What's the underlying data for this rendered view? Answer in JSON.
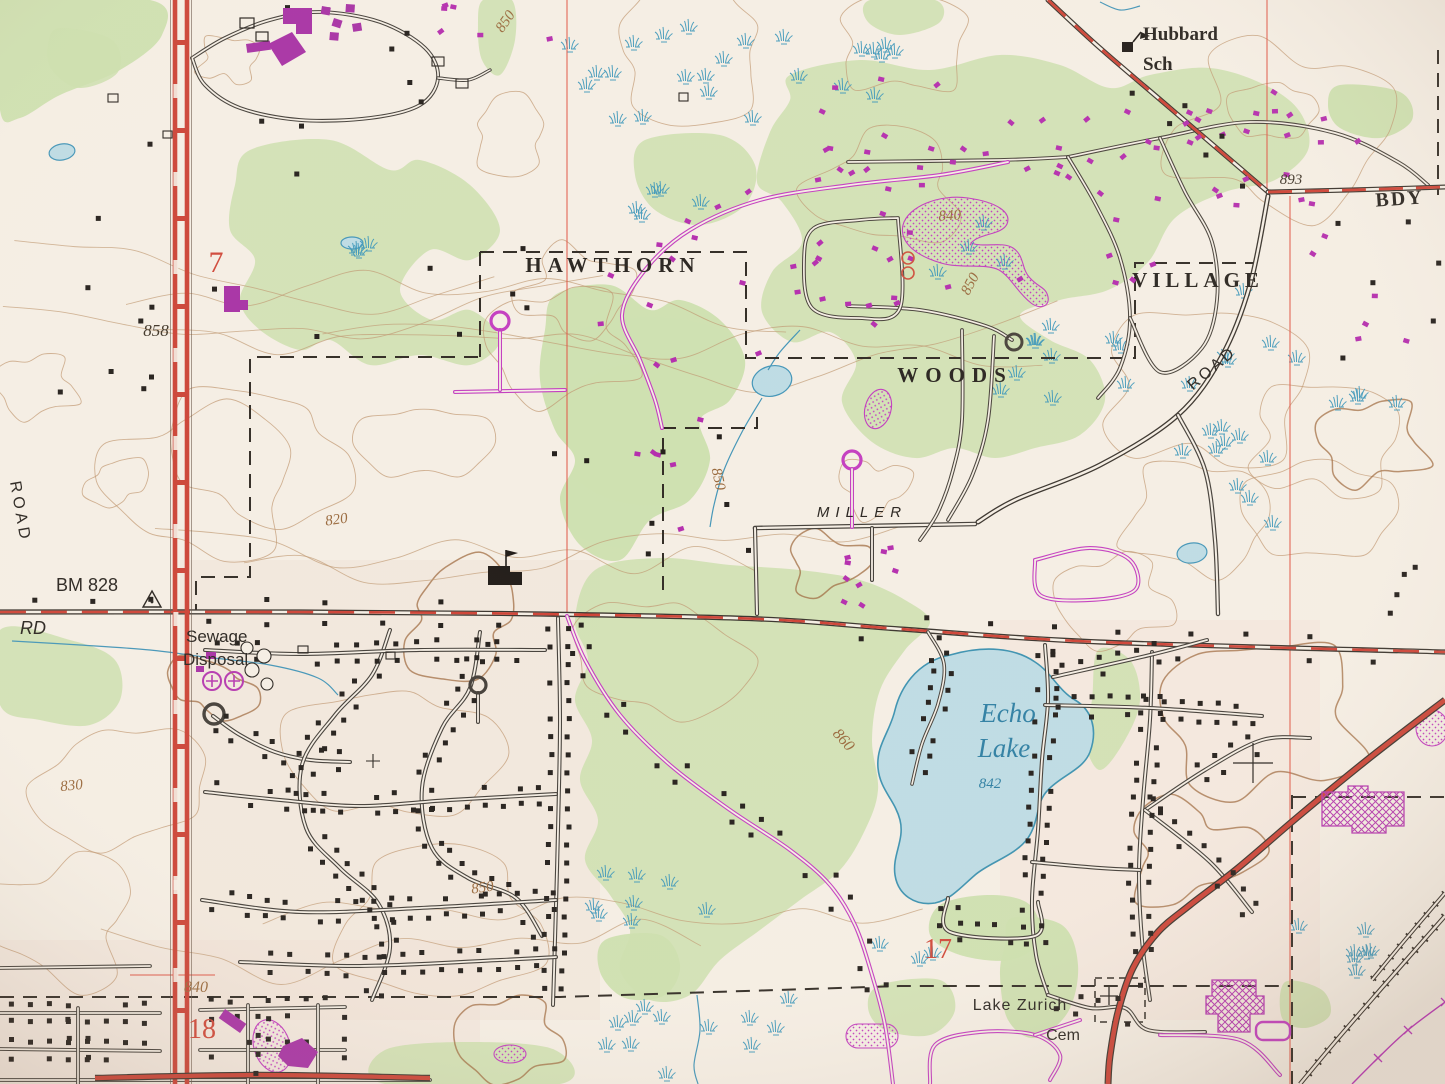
{
  "labels": {
    "hawthorn": "HAWTHORN",
    "woods": "WOODS",
    "village": "VILLAGE",
    "hubbard_line1": "Hubbard",
    "hubbard_line2": "Sch",
    "bdy": "BDY",
    "road_ne": "ROAD",
    "road_w": "ROAD",
    "miller": "MILLER",
    "rd": "RD",
    "sewage_line1": "Sewage",
    "sewage_line2": "Disposal",
    "bm": "BM 828",
    "echo_line1": "Echo",
    "echo_line2": "Lake",
    "lake_elev": "842",
    "cem_line1": "Lake Zurich",
    "cem_line2": "Cem",
    "elev_858": "858",
    "elev_893": "893",
    "contour_820": "820",
    "contour_830": "830",
    "contour_840_n": "840",
    "contour_840_s": "840",
    "contour_850_nw": "850",
    "contour_850_ne": "850",
    "contour_850_c": "850",
    "contour_850_sw": "850",
    "contour_860": "860",
    "sec_7": "7",
    "sec_17": "17",
    "sec_18": "18"
  },
  "symbols": {
    "benchmark": "triangle-with-dot",
    "school": "building-with-flag",
    "cemetery": "cross",
    "marsh": "blue-tuft",
    "railroad": "tied-track",
    "power_line": "magenta-x-line"
  },
  "colors": {
    "paper": "#f5eee4",
    "woods_green": "#ccdfae",
    "water_fill": "#bedce4",
    "water_line": "#4596b8",
    "contour_brown": "#bb8e66",
    "contour_index": "#a06c42",
    "highway_red": "#cc4437",
    "section_red": "#e05848",
    "revision_magenta": "#bd38bb",
    "ink_black": "#2b2621"
  }
}
